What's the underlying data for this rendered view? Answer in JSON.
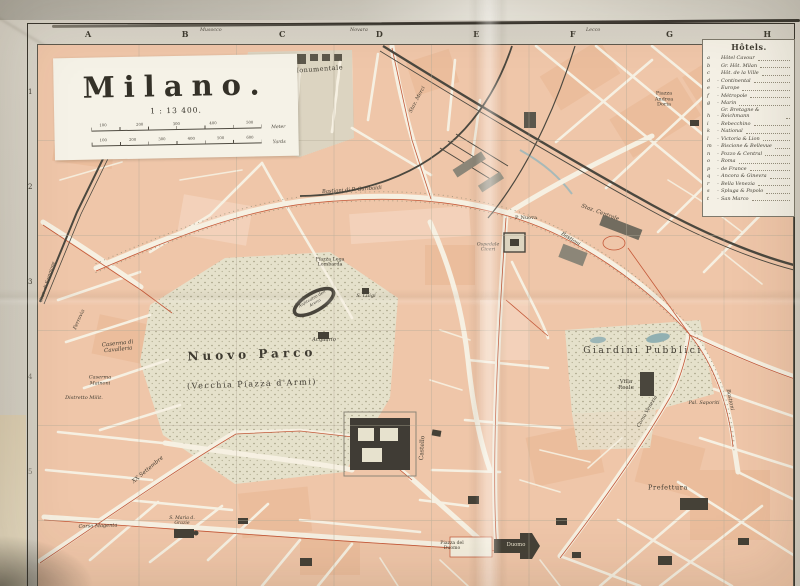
{
  "sheet": {
    "title": "Milano.",
    "scale_text": "1 : 13 400.",
    "scale_bars": {
      "meters": {
        "ticks": [
          "100",
          "200",
          "300",
          "400",
          "500"
        ],
        "unit": "Meter"
      },
      "yards": {
        "ticks": [
          "100",
          "200",
          "300",
          "400",
          "500",
          "600"
        ],
        "unit": "Yards"
      }
    }
  },
  "grid": {
    "columns": [
      "A",
      "B",
      "C",
      "D",
      "E",
      "F",
      "G",
      "H"
    ],
    "rows": [
      "1",
      "2",
      "3",
      "4",
      "5"
    ],
    "margin_labels": {
      "b_c": "Musocco",
      "c_d": "Novara",
      "f": "Lecco"
    }
  },
  "hotels": {
    "title": "Hôtels.",
    "items": [
      {
        "key": "a",
        "sep": "",
        "name": "Hôtel Cavour"
      },
      {
        "key": "b",
        "sep": "",
        "name": "Gr. Hôt. Milan"
      },
      {
        "key": "c",
        "sep": "",
        "name": "Hôt. de la Ville"
      },
      {
        "key": "d",
        "sep": "-",
        "name": "Continental"
      },
      {
        "key": "e",
        "sep": "-",
        "name": "Europe"
      },
      {
        "key": "f",
        "sep": "-",
        "name": "Métropole"
      },
      {
        "key": "g",
        "sep": "-",
        "name": "Marin"
      },
      {
        "key": "h",
        "sep": "-",
        "name": "Gr. Bretagne & Reichmann"
      },
      {
        "key": "i",
        "sep": "-",
        "name": "Rebecchino"
      },
      {
        "key": "k",
        "sep": "-",
        "name": "National"
      },
      {
        "key": "l",
        "sep": "-",
        "name": "Victoria & Lion"
      },
      {
        "key": "m",
        "sep": "-",
        "name": "Biscione & Bellevue"
      },
      {
        "key": "n",
        "sep": "-",
        "name": "Pozzo & Central"
      },
      {
        "key": "o",
        "sep": "-",
        "name": "Roma"
      },
      {
        "key": "p",
        "sep": "-",
        "name": "de France"
      },
      {
        "key": "q",
        "sep": "-",
        "name": "Ancora & Ginevra"
      },
      {
        "key": "r",
        "sep": "-",
        "name": "Bella Venezia"
      },
      {
        "key": "s",
        "sep": "-",
        "name": "Spluga & Popolo"
      },
      {
        "key": "t",
        "sep": "-",
        "name": "San Marco"
      }
    ]
  },
  "labels": {
    "cimitero": "Cimitero Monumentale",
    "stazione_merci": "Staz. Merci",
    "staz_centrale": "Staz. Centrale",
    "piazza_doria": "Piazza Andrea Doria",
    "bastioni_garibaldi": "Bastioni di P. Garibaldi",
    "bastioni_ne": "Bastioni",
    "bastioni_e": "Bastioni",
    "ferrovia": "Ferrovia",
    "staz_sempione": "Staz. di Sempione",
    "nuovo_parco": "Nuovo Parco",
    "vecchia_piazza": "(Vecchia Piazza d'Armi)",
    "castello": "Castello",
    "acquario": "Acquario",
    "anfiteatro": "Anfiteatro dell' Arena",
    "s_luigi": "S. Luigi",
    "piazza_lega": "Piazza Lega Lombarda",
    "giardini": "Giardini Pubblici",
    "villa_reale": "Villa Reale",
    "pal_saporiti": "Pal. Saporiti",
    "p_nuova": "P. Nuova",
    "ospedale_ciceri": "Ospedale Ciceri",
    "corso_venezia": "Corso Venezia",
    "caserma_cavalleria": "Caserma di Cavalleria",
    "caserma_mainoni": "Caserma Mainoni",
    "distretto": "Distretto Milit.",
    "xx_settembre": "XX Settembre",
    "corso_magenta": "Corso Magenta",
    "s_maria_grazie": "S. Maria d. Grazie",
    "piazza_duomo": "Piazza del Duomo",
    "duomo": "Duomo",
    "prefettura": "Prefettura"
  },
  "colors": {
    "block_pink": "#f1c7ab",
    "park": "#e7e3cf",
    "street": "#f8f3e6",
    "railway": "#46443d",
    "tram_red": "#c14f30",
    "water": "#8fb0b5",
    "paper": "#d5d1c7",
    "frame": "#33312a"
  }
}
